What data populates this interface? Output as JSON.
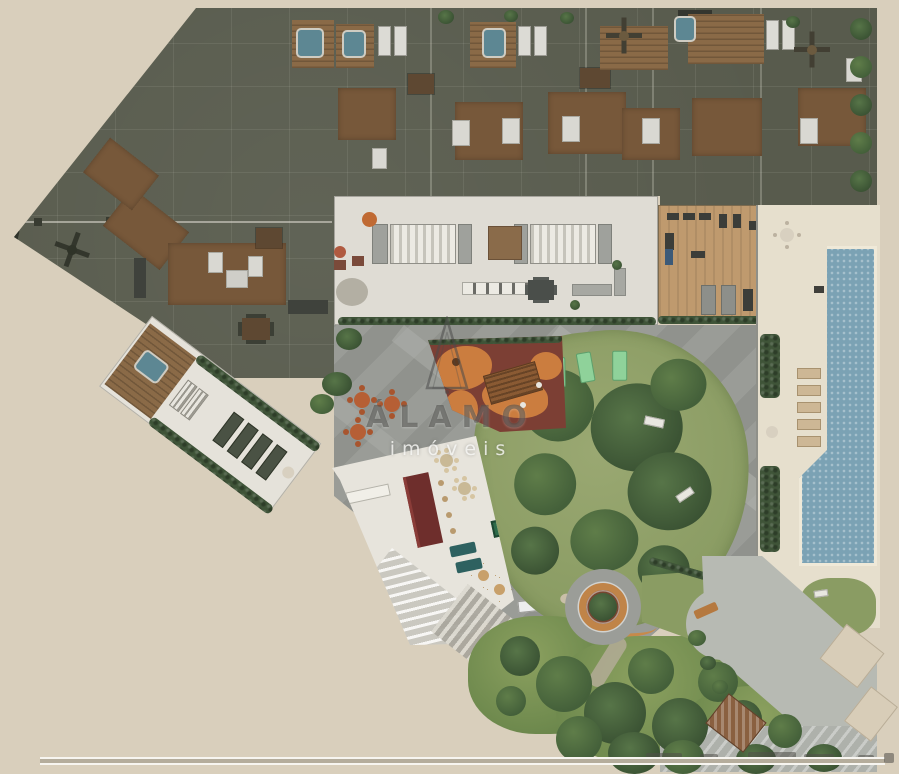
{
  "watermark": {
    "brand": "ÁLAMO",
    "tagline": "imóveis",
    "logo_icon": "poplar-triangle-logo"
  },
  "colors": {
    "bg": "#d9cfbc",
    "plate": "#585b4d",
    "wood": "#77583a",
    "woodDark": "#5e4832",
    "bed": "#d9d8d2",
    "deckWood": "#8a6a47",
    "tub": "#5d8793",
    "amen": "#dfdcd4",
    "stair": "#eceae3",
    "gymWood": "#bf9a6e",
    "gymDark": "#3b3d39",
    "poolDeck": "#e6dfcd",
    "water": "#7ba2b4",
    "hedge": "#3f5438",
    "pave": "#9a9c97",
    "paveLight": "#b2b4af",
    "lawn": "#8a9c63",
    "treeHi": "#5f7d49",
    "treeLo": "#44603a",
    "treeDark": "#3a5233",
    "playBase": "#7c3f34",
    "playOrange": "#d08140",
    "playWood": "#8a5a33",
    "ringOrange": "#c08448",
    "ringInner": "#77452f",
    "partyFloor": "#e7e4dc",
    "barRed": "#6e2e2c",
    "poolTable": "#2d6b4a",
    "teal": "#2e6160",
    "drive": "#b7bab3",
    "driveLight": "#aeb1ab",
    "roofBrown": "#8a6040",
    "roofBeige": "#d8cdb8",
    "patioTable": "#b65f35",
    "patioChair": "#a8552e",
    "loungerTan": "#cdb795",
    "mint": "#8fd29a",
    "benchWood": "#b5793f",
    "scaleLine": "#f7f5f0",
    "scaleFill": "#b5ad9c",
    "inkDark": "rgba(72,72,70,0.55)",
    "inkLight": "rgba(250,250,247,0.8)"
  }
}
